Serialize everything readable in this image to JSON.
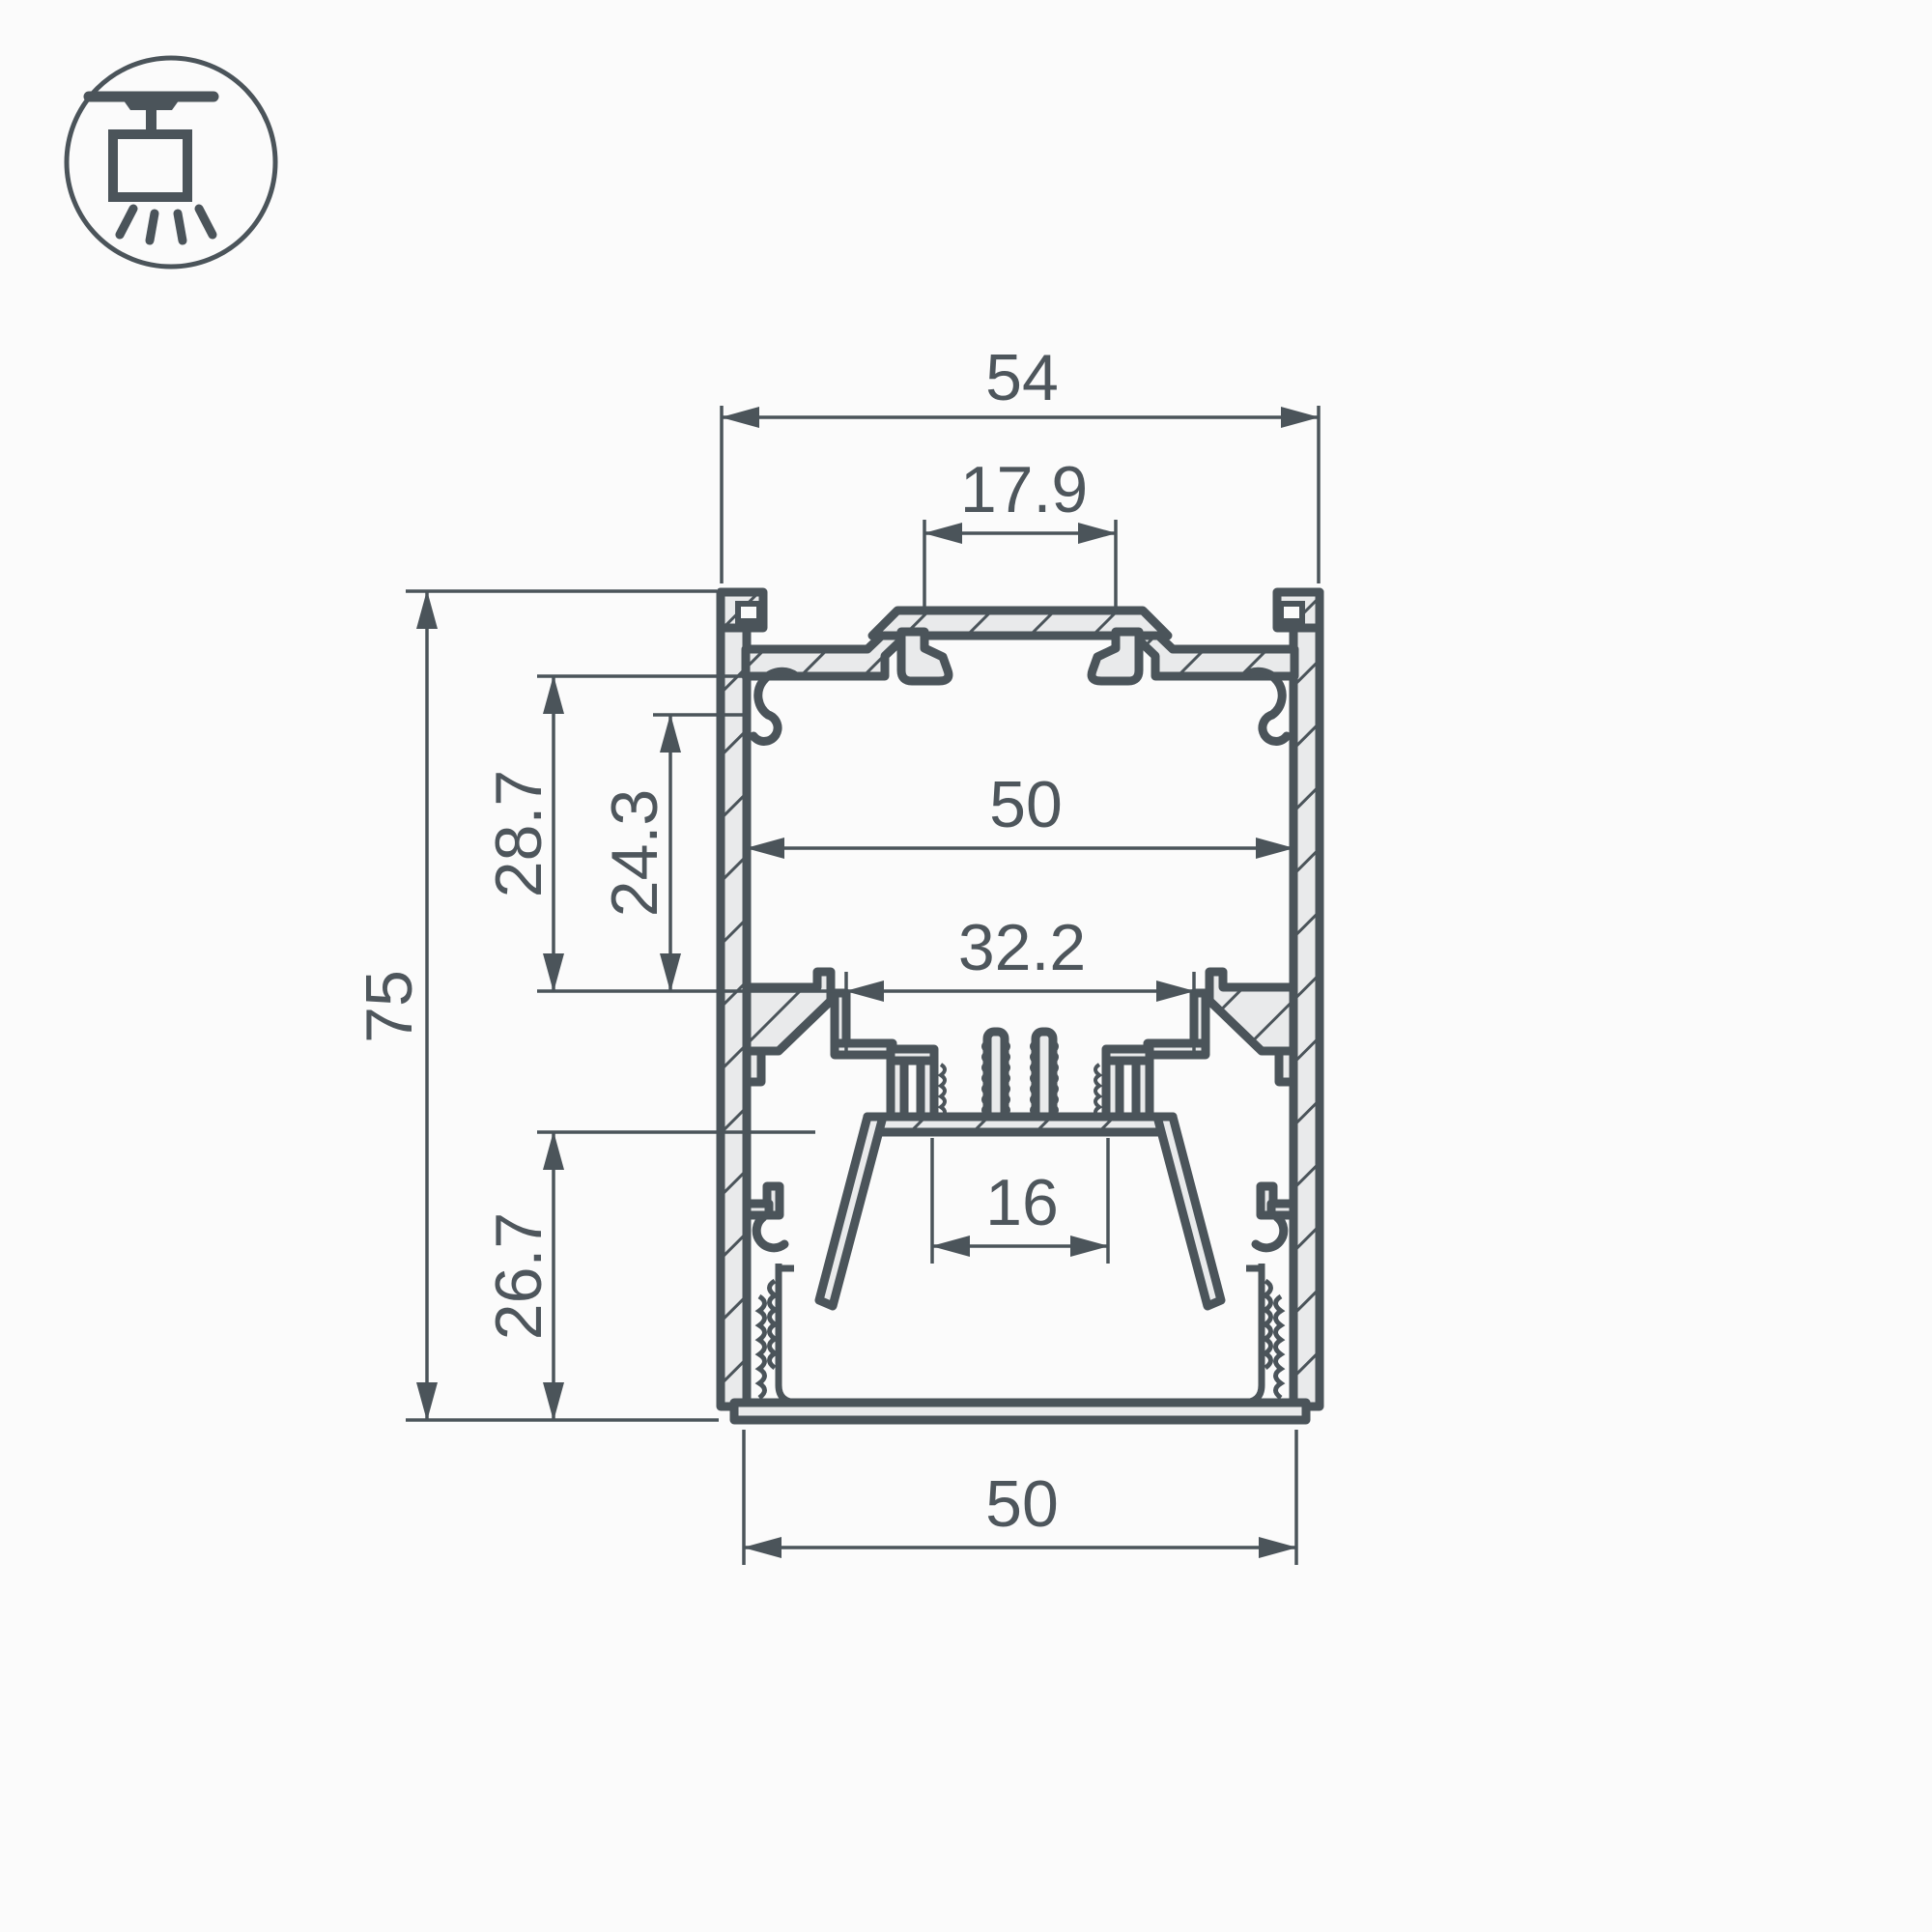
{
  "meta": {
    "title": "Suspended LED aluminium profile cross-section drawing",
    "drawing_type": "technical-cross-section"
  },
  "colors": {
    "background": "#fbfbfb",
    "line": "#4b545a",
    "aluminium_fill": "#e9eaeb"
  },
  "icon": {
    "name": "ceiling-suspended-luminaire"
  },
  "dims": {
    "overall_width": "54",
    "slot_width": "17.9",
    "inner_width": "50",
    "cavity_width": "32.2",
    "upper_depth": "28.7",
    "upper_inner_depth": "24.3",
    "overall_height": "75",
    "lower_depth": "26.7",
    "led_seat_width": "16",
    "bottom_width": "50"
  }
}
